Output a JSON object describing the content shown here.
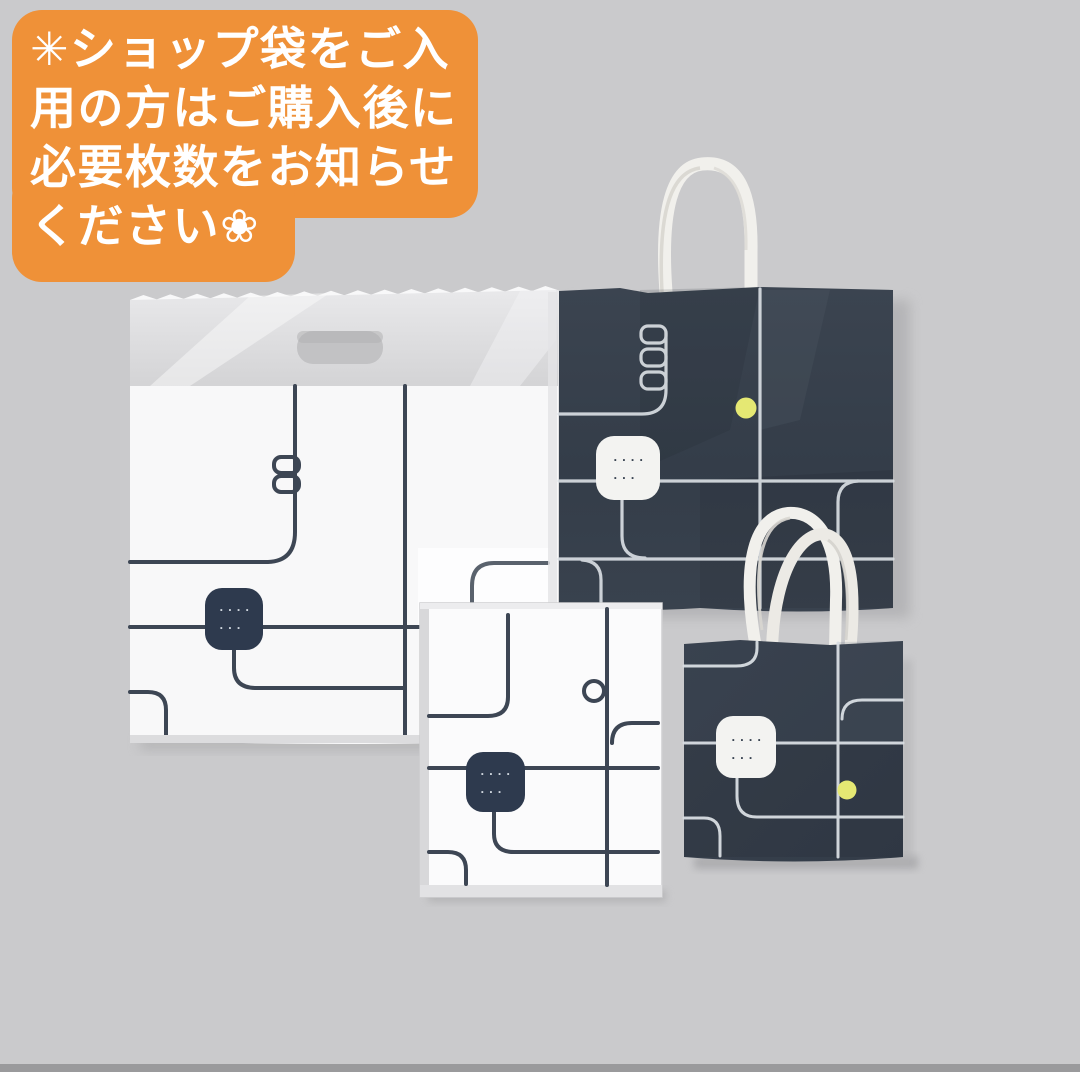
{
  "colors": {
    "background": "#cacacc",
    "bottom_edge_strip": "#9a9a9c",
    "banner_orange": "#ef9138",
    "banner_text": "#ffffff",
    "navy_large_bag": "#363f4b",
    "navy_small_bag": "#3b4451",
    "navy_patch": "#2e3a4e",
    "print_on_navy": "#d9dee3",
    "print_on_white": "#3d4654",
    "white_patch": "#f3f3f1",
    "plastic_bag_white": "#f8f8f9",
    "flat_bag_white": "#fbfbfc",
    "plastic_top_film": "#dfdfe1",
    "handle_cutout_gray": "#c2c2c4",
    "rope": "#f1f0ec",
    "rope_shade": "#d8d6d0",
    "yellow_dot": "#e5e873"
  },
  "banner": {
    "lines": [
      "✳ショップ袋をご入",
      "用の方はご購入後に",
      "必要枚数をお知らせ",
      "ください❀"
    ]
  },
  "bags": {
    "plastic_bag": {
      "name": "white plastic handle bag"
    },
    "large_paper_bag": {
      "name": "navy paper bag with rope handles"
    },
    "flat_paper_bag": {
      "name": "white flat paper bag"
    },
    "small_paper_bag": {
      "name": "small navy paper bag with rope handles"
    }
  },
  "patch_marks": {
    "line1": "····",
    "line2": "···"
  }
}
